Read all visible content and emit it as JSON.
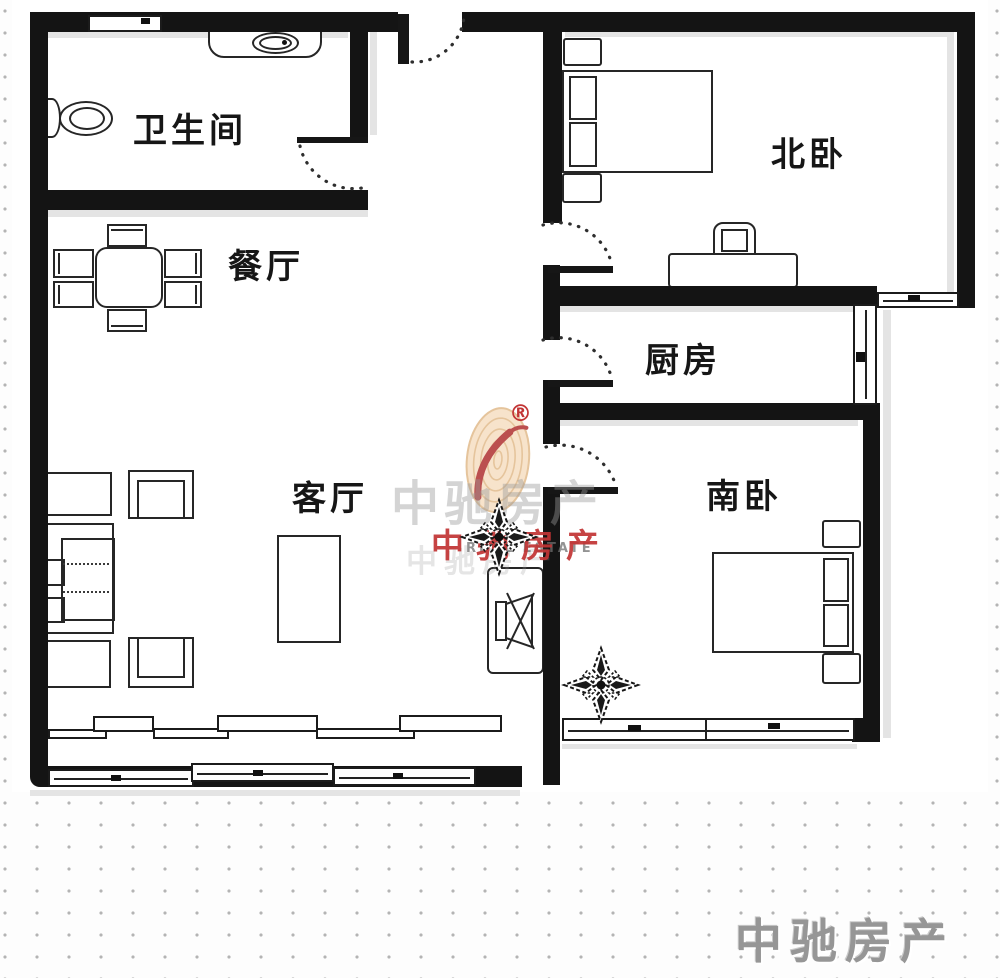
{
  "rooms": {
    "bathroom": {
      "label": "卫生间"
    },
    "dining": {
      "label": "餐厅"
    },
    "living": {
      "label": "客厅"
    },
    "kitchen": {
      "label": "厨房"
    },
    "north_bedroom": {
      "label": "北卧"
    },
    "south_bedroom": {
      "label": "南卧"
    }
  },
  "watermark": {
    "registered": "®",
    "gray_text": "中驰房产",
    "ghost_text": "中驰房产",
    "red_text": "中驰房产",
    "sub_text": "REAL ESTATE"
  },
  "corner": {
    "brand": "中驰房产"
  },
  "icons": {
    "fingerprint_stamp": "fingerprint-stamp-icon",
    "compass_ornament": "compass-flower-icon",
    "toilet": "toilet-icon",
    "sink": "sink-icon",
    "tv": "tv-icon"
  },
  "colors": {
    "wall": "#141414",
    "shadow": "#e4e4e4",
    "label": "#161616",
    "watermark_red": "#c23434",
    "watermark_gray": "#9a9a9a",
    "corner_brand": "#969696",
    "fingerprint_fill": "#f6e0c4",
    "fingerprint_line": "#e2bd8f",
    "dot_grid": "#b4b4b4"
  }
}
